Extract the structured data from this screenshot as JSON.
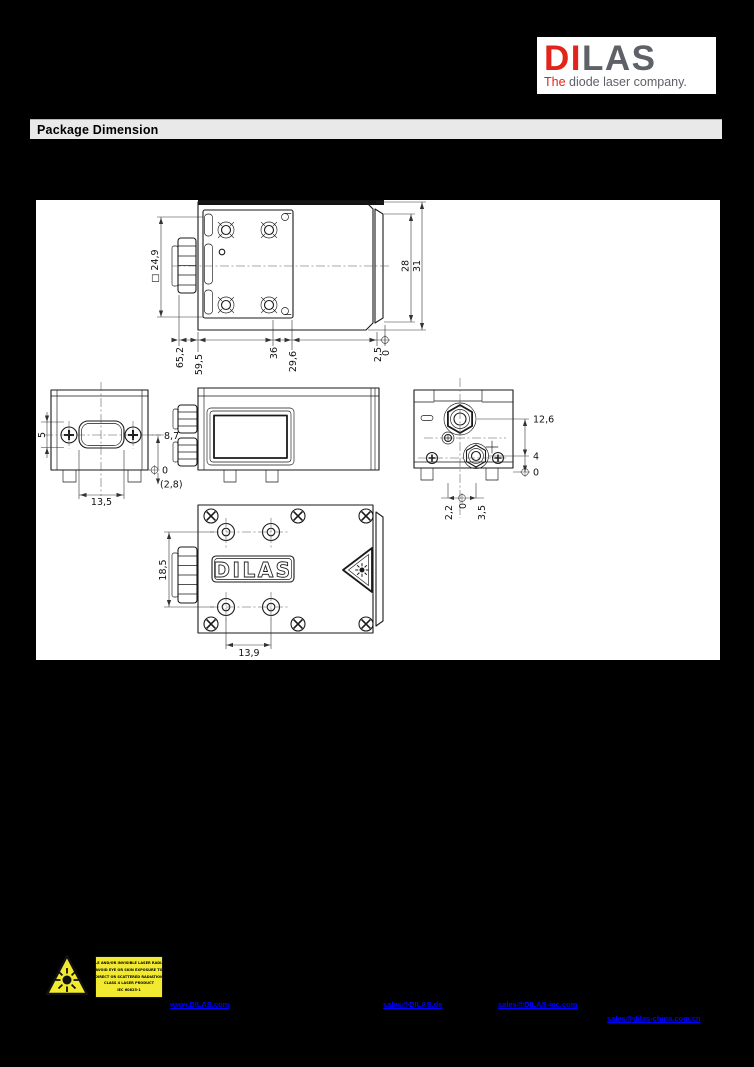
{
  "colors": {
    "accent_red": "#e1251b",
    "logo_gray": "#5e6167",
    "link_blue": "#0000ff",
    "label_yellow": "#f2ea30",
    "bar_gray": "#e9e9e9"
  },
  "logo": {
    "word_red": "DI",
    "word_gray": "LAS",
    "tagline_red": "The",
    "tagline_gray": " diode laser company."
  },
  "section": {
    "title": "Package Dimension"
  },
  "views": {
    "top": {
      "dims": {
        "side_square": "□ 24,9",
        "len_total": "65,2",
        "len_body": "59,5",
        "hole_pitch": "36",
        "len_right": "29,6",
        "offset": "2,5",
        "zero": "0",
        "height_inner": "28",
        "height_total": "31"
      }
    },
    "left": {
      "dims": {
        "slot_height": "5",
        "slot_width": "13,5",
        "height_top": "8,7",
        "zero": "0",
        "foot": "(2,8)"
      }
    },
    "right": {
      "dims": {
        "fiber_height": "12,6",
        "conn_height": "4",
        "zero_side": "0",
        "off_left": "2,2",
        "zero_bottom": "0",
        "off_right": "3,5"
      }
    },
    "bottom": {
      "brand": "DILAS",
      "dims": {
        "hole_span": "18,5",
        "hole_pitch": "13,9"
      }
    }
  },
  "footer": {
    "warning_label": {
      "lines": [
        "VISIBLE AND/OR INVISIBLE LASER RADIATION",
        "AVOID EYE OR SKIN EXPOSURE TO",
        "DIRECT OR SCATTERED RADIATION",
        "CLASS 4 LASER PRODUCT",
        "IEC 60825-1"
      ]
    },
    "links": [
      {
        "label": "www.DILAS.com"
      },
      {
        "label": "sales@DILAS.de"
      },
      {
        "label": "sales@DILAS-inc.com"
      },
      {
        "label": "sales@dilas-china.com.cn"
      }
    ]
  }
}
